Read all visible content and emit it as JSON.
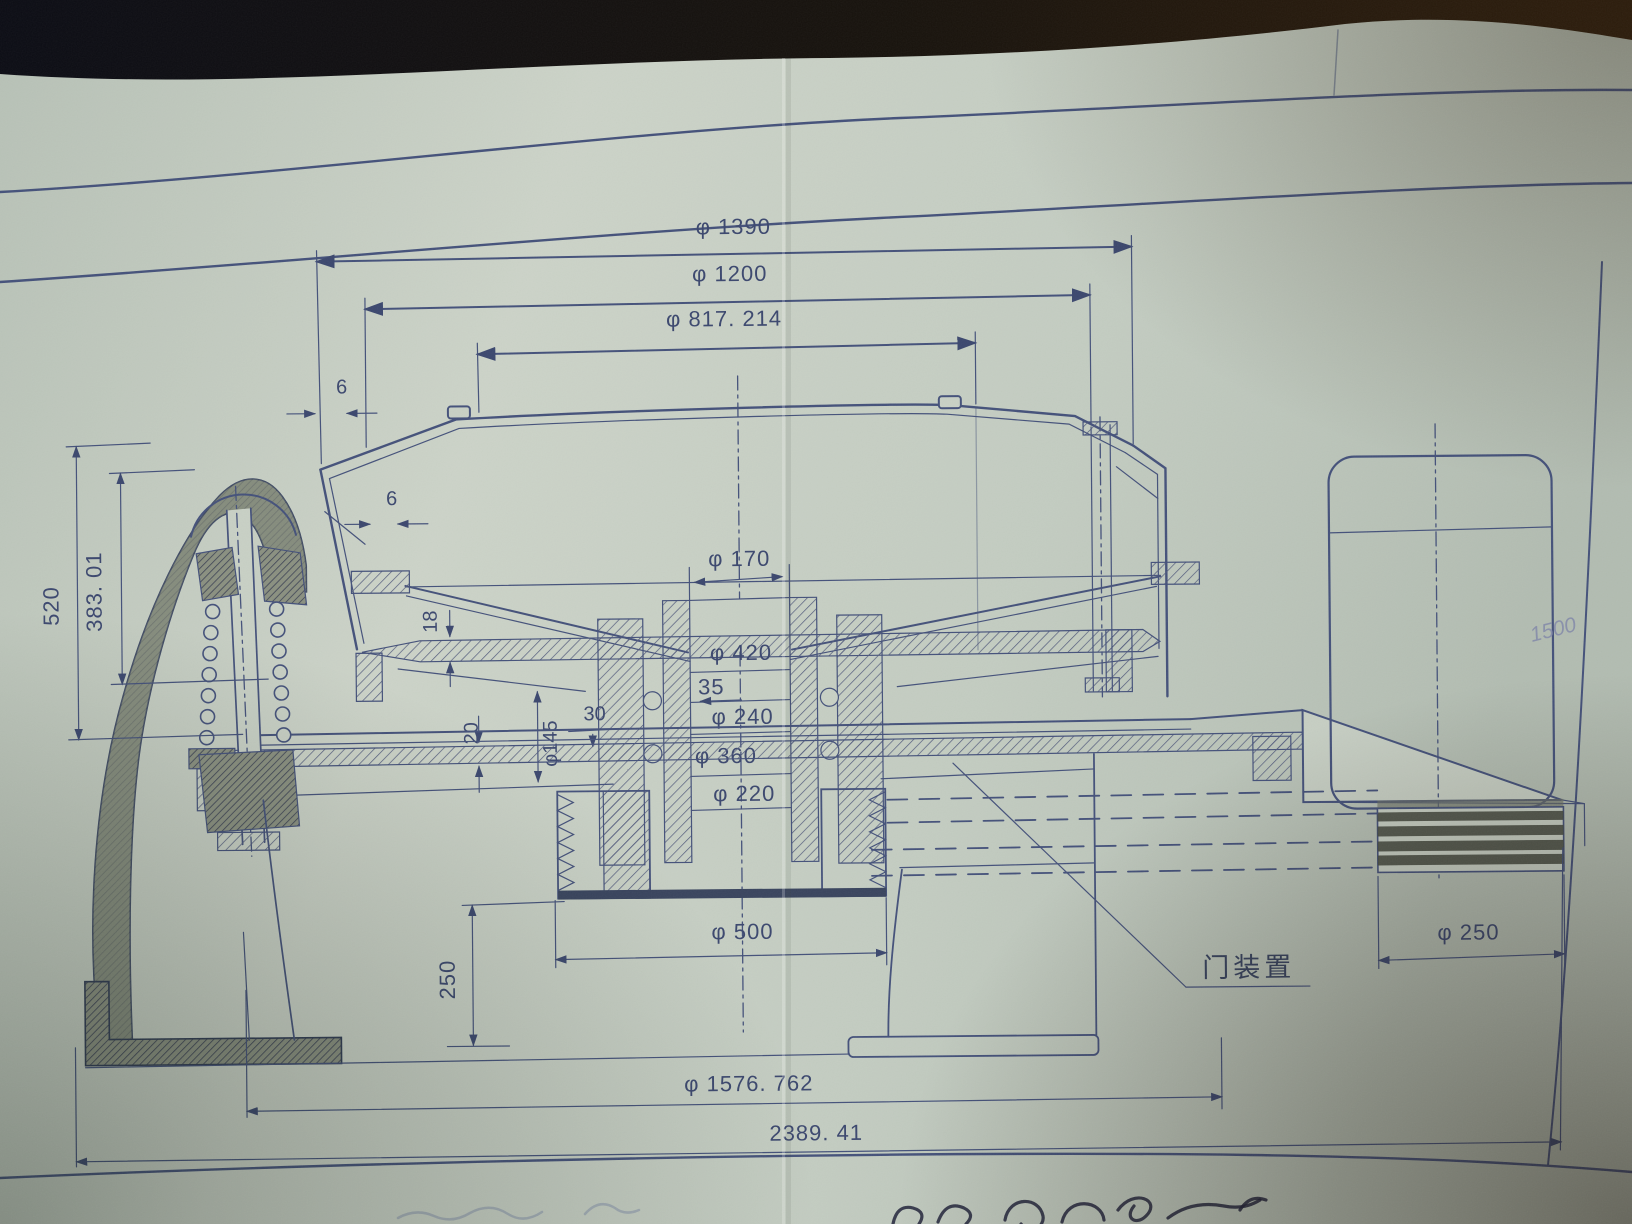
{
  "photo": {
    "paper_color": "#c6cec3",
    "ink_color": "#44517a",
    "background_color": "#14110d"
  },
  "drawing": {
    "dims": {
      "top": {
        "d1390": "φ 1390",
        "d1200": "φ 1200",
        "d817": "φ 817. 214"
      },
      "left": {
        "d520": "520",
        "d383": "383. 01"
      },
      "shaft": {
        "d170": "φ 170",
        "d420": "φ 420",
        "d35": "35",
        "d240": "φ 240",
        "d360": "φ 360",
        "d220": "φ 220"
      },
      "small": {
        "d6a": "6",
        "d6b": "6",
        "d18": "18",
        "d20": "20",
        "d145": "φ145",
        "d30": "30"
      },
      "bottom": {
        "d500": "φ 500",
        "d250v": "250",
        "d1576": "φ 1576. 762",
        "d2389": "2389. 41"
      },
      "right": {
        "d250": "φ 250"
      }
    },
    "labels": {
      "door_device": "门装置"
    },
    "handwriting": {
      "margin_note": "1500"
    }
  }
}
